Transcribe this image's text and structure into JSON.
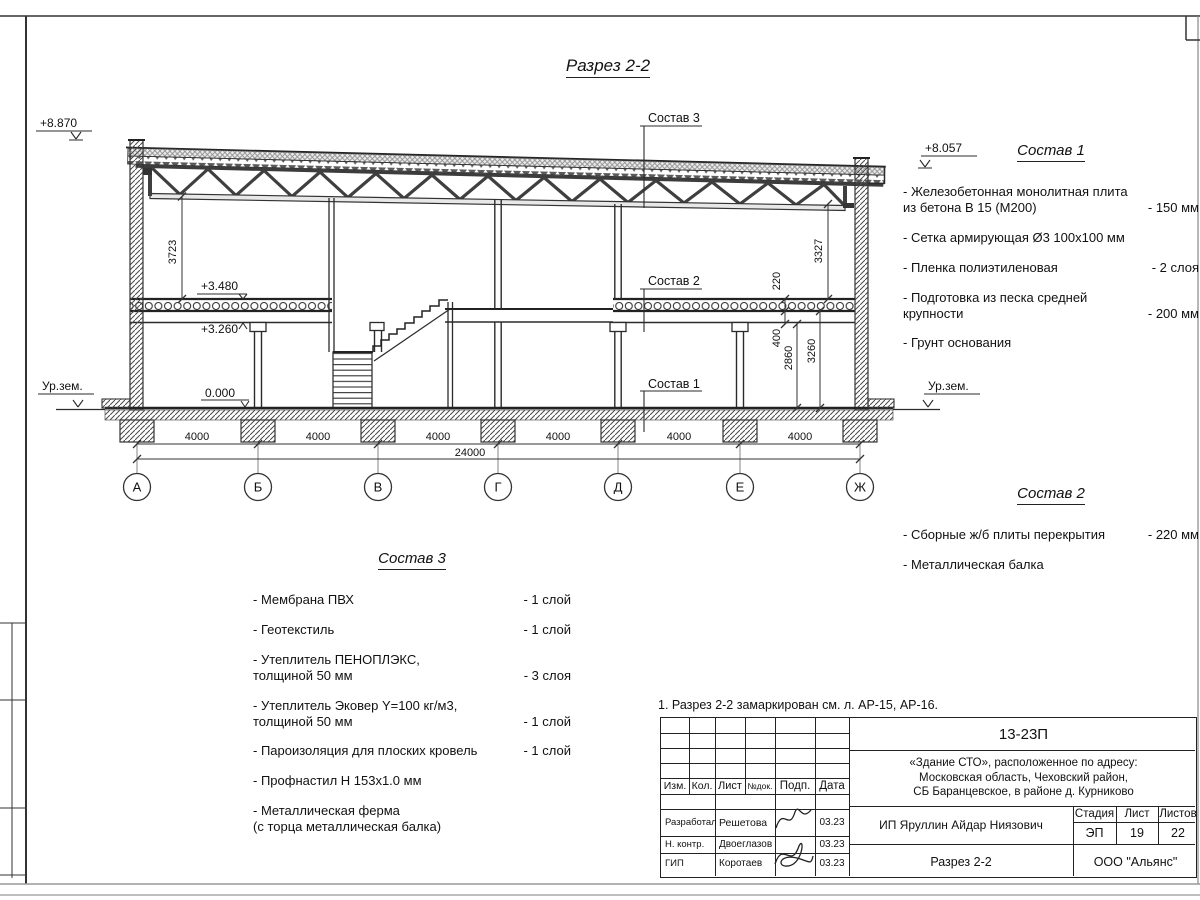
{
  "sheet": {
    "title": "Разрез 2-2",
    "note": "1. Разрез 2-2 замаркирован см. л. АР-15, АР-16."
  },
  "section": {
    "elevations": {
      "parapet_left": "+8.870",
      "roof_right": "+8.057",
      "ground_left": "Ур.зем.",
      "ground_right": "Ур.зем.",
      "slab_top": "+3.480",
      "slab_bottom": "+3.260",
      "floor": "0.000"
    },
    "dims": {
      "hall_left": "3723",
      "hall_right": "3327",
      "slab": "220",
      "beam": "400",
      "clear_first": "2860",
      "first_floor": "3260",
      "total": "24000"
    },
    "axes": {
      "labels": [
        "А",
        "Б",
        "В",
        "Г",
        "Д",
        "Е",
        "Ж"
      ],
      "bays": [
        "4000",
        "4000",
        "4000",
        "4000",
        "4000",
        "4000"
      ]
    },
    "callouts": {
      "c1": "Состав 1",
      "c2": "Состав 2",
      "c3": "Состав 3"
    }
  },
  "sostav1": {
    "title": "Состав 1",
    "items": [
      {
        "name": "- Железобетонная  монолитная плита\nиз бетона В 15 (М200)",
        "value": "- 150 мм"
      },
      {
        "name": "- Сетка армирующая Ø3 100х100 мм",
        "value": ""
      },
      {
        "name": "- Пленка полиэтиленовая",
        "value": "- 2 слоя"
      },
      {
        "name": "- Подготовка из песка средней\nкрупности",
        "value": "- 200 мм"
      },
      {
        "name": "- Грунт основания",
        "value": ""
      }
    ]
  },
  "sostav2": {
    "title": "Состав 2",
    "items": [
      {
        "name": "- Сборные ж/б плиты перекрытия",
        "value": "- 220 мм"
      },
      {
        "name": "- Металлическая  балка",
        "value": ""
      }
    ]
  },
  "sostav3": {
    "title": "Состав 3",
    "items": [
      {
        "name": "- Мембрана ПВХ",
        "value": "- 1 слой"
      },
      {
        "name": "- Геотекстиль",
        "value": "- 1 слой"
      },
      {
        "name": "- Утеплитель ПЕНОПЛЭКС,\nтолщиной 50 мм",
        "value": "- 3 слоя"
      },
      {
        "name": "- Утеплитель Эковер Y=100 кг/м3,\nтолщиной 50 мм",
        "value": "- 1 слой"
      },
      {
        "name": "- Пароизоляция для плоских кровель",
        "value": "- 1 слой"
      },
      {
        "name": "- Профнастил Н 153х1.0 мм",
        "value": ""
      },
      {
        "name": "- Металлическая ферма\n(с торца металлическая балка)",
        "value": ""
      }
    ]
  },
  "titleblock": {
    "doc_number": "13-23П",
    "project": "«Здание СТО», расположенное по адресу:\nМосковская область, Чеховский район,\nСБ Баранцевское, в районе д. Курниково",
    "client": "ИП Яруллин Айдар Ниязович",
    "drawing_name": "Разрез 2-2",
    "company": "ООО \"Альянс\"",
    "stage_label": "Стадия",
    "stage": "ЭП",
    "sheet_label": "Лист",
    "sheet_no": "19",
    "sheets_label": "Листов",
    "sheets_total": "22",
    "cols": {
      "izm": "Изм.",
      "kol": "Кол.",
      "list": "Лист",
      "doc": "№док.",
      "sign": "Подп.",
      "date": "Дата"
    },
    "rows": [
      {
        "role": "Разработал",
        "name": "Решетова",
        "date": "03.23"
      },
      {
        "role": "Н. контр.",
        "name": "Двоеглазов",
        "date": "03.23"
      },
      {
        "role": "ГИП",
        "name": "Коротаев",
        "date": "03.23"
      }
    ]
  }
}
